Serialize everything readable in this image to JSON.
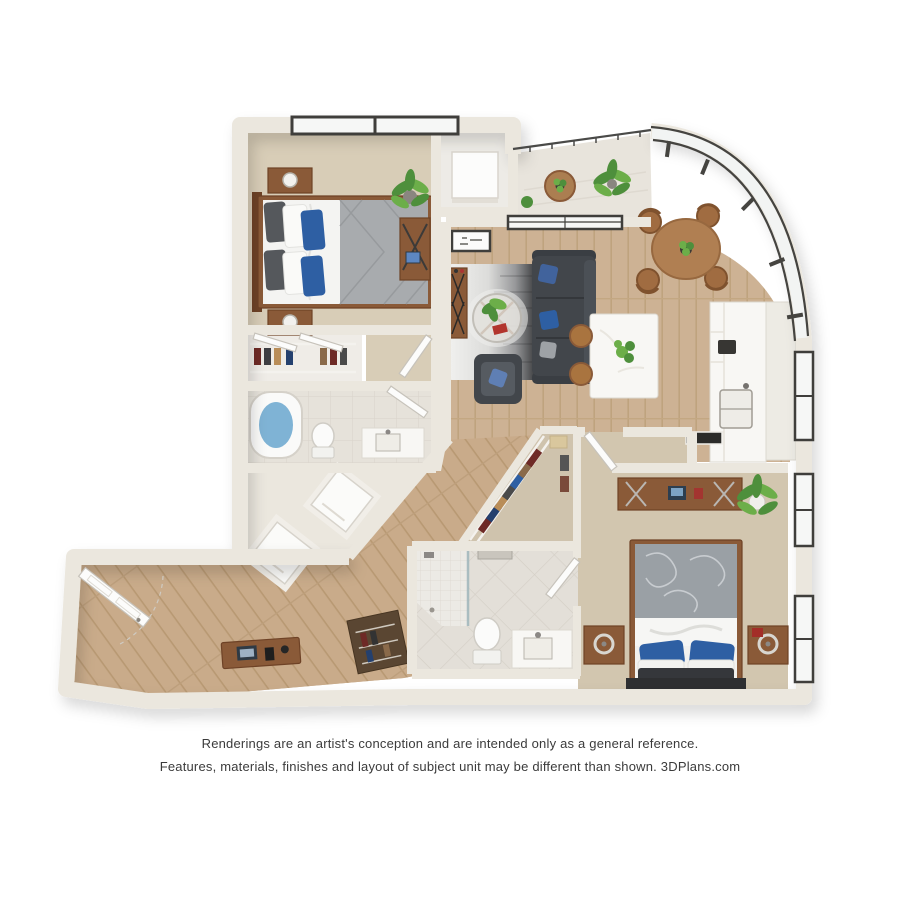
{
  "page": {
    "background_color": "#ffffff",
    "type": "3d-floor-plan-rendering",
    "subject": "two bedroom two bathroom apartment floor plan"
  },
  "disclaimer": {
    "line1": "Renderings are an artist's conception and are intended only as a general reference.",
    "line2": "Features, materials, finishes and layout of subject unit may be different than shown. 3DPlans.com",
    "brand": "3DPlans.com"
  },
  "palette": {
    "wall": "#ebe7de",
    "wallEdge": "#d9d3c7",
    "carpet": "#d8cdb7",
    "carpet2": "#d2c6af",
    "wood": "#cdb294",
    "woodLine": "#bfa37e",
    "tile": "#e6e2da",
    "tileLine": "#d8d3ca",
    "glass": "#f6f7f6",
    "frame": "#3f3e3b",
    "furnWood": "#8a5a38",
    "furnWoodDark": "#6e4226",
    "sofa": "#42464b",
    "blue": "#2e5fa3",
    "plant": "#4e8f3c",
    "plantL": "#6cae49",
    "white": "#fbfbfa",
    "marble": "#f8f7f4",
    "water": "#7fb3d5",
    "rugDark": "#2c2d2f"
  },
  "rooms": [
    {
      "name": "Bedroom 1",
      "furnishings": [
        "queen bed with blue pillows and gray quilt",
        "two nightstands with lamps",
        "desk with tablet",
        "potted palm",
        "picture window"
      ]
    },
    {
      "name": "Closet 1",
      "furnishings": [
        "wire shelving",
        "hanging clothes",
        "two angled doors"
      ]
    },
    {
      "name": "Bathroom 1",
      "furnishings": [
        "soaking tub",
        "toilet",
        "vanity"
      ]
    },
    {
      "name": "Laundry nooks",
      "furnishings": [
        "washer",
        "dryer"
      ]
    },
    {
      "name": "Entry hall",
      "furnishings": [
        "front door",
        "console table with laptop and phone",
        "coat shelving"
      ]
    },
    {
      "name": "Diagonal hallway",
      "furnishings": [
        "wood flooring"
      ]
    },
    {
      "name": "Living room",
      "furnishings": [
        "gray sectional sofa with blue pillows",
        "armchair",
        "round glass coffee table with plant and red book",
        "gradient area rug",
        "console table",
        "framed wall art",
        "sliding glass door"
      ]
    },
    {
      "name": "Balcony",
      "furnishings": [
        "glass railing",
        "bistro table",
        "potted plants"
      ]
    },
    {
      "name": "Dining area",
      "furnishings": [
        "round wood table with plant centerpiece",
        "four chairs",
        "curved floor-to-ceiling window wall"
      ]
    },
    {
      "name": "Kitchen",
      "furnishings": [
        "counter run with sink",
        "upper cabinets",
        "dark-top peninsula",
        "marble island with plant",
        "two bar stools",
        "window"
      ]
    },
    {
      "name": "Walk-in closet",
      "furnishings": [
        "wire shelving",
        "hanging clothes"
      ]
    },
    {
      "name": "Bathroom 2",
      "furnishings": [
        "walk-in shower",
        "rain shower head",
        "toilet",
        "marble vanity"
      ]
    },
    {
      "name": "Bedroom 2",
      "furnishings": [
        "queen bed with gray floral duvet and blue pillows",
        "two nightstands with ring lamps",
        "desk with laptop",
        "potted palm",
        "two windows"
      ]
    }
  ]
}
